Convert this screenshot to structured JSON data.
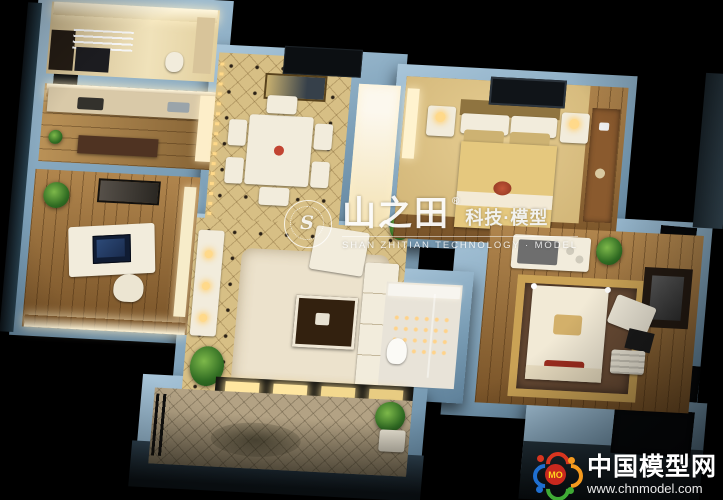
{
  "watermark": {
    "stamp_initial": "S",
    "brand": "山之田",
    "registered_mark": "®",
    "brand_suffix": "科技·模型",
    "subtitle": "SHAN ZHITIAN TECHNOLOGY · MODEL"
  },
  "footer_logo": {
    "badge_text": "MO",
    "site_name": "中国模型网",
    "site_url": "www.chnmodel.com"
  },
  "palette": {
    "background": "#000000",
    "wall_top": "#a9c6da",
    "wall_mid": "#7b9eb6",
    "wall_shadow": "#5e8099",
    "floor_gold": "#d7bf85",
    "floor_wood": "#9a6a33",
    "cove_light": "#fff7df",
    "led_warm": "#ffd98a",
    "badge_red": "#d8351f",
    "badge_orange": "#f59a1e",
    "badge_green": "#3faa35",
    "badge_blue": "#1f6fd0",
    "badge_center": "#c8281e",
    "badge_text_color": "#ffd21e"
  }
}
